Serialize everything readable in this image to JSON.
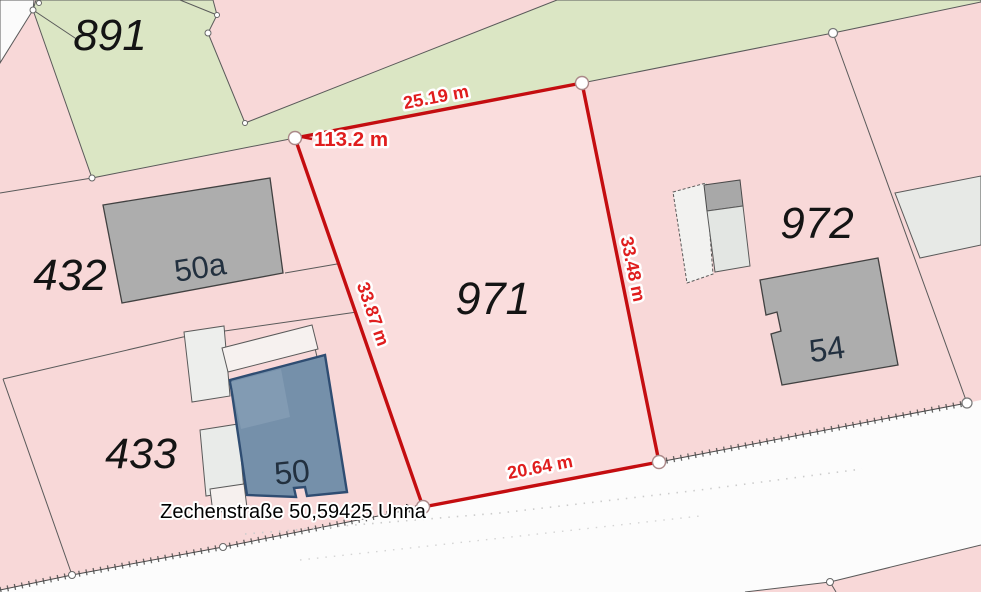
{
  "map": {
    "type": "cadastral-parcel-map",
    "labels": {
      "parcel_891": "891",
      "parcel_432": "432",
      "parcel_433": "433",
      "parcel_971": "971",
      "parcel_972": "972",
      "building_50a": "50a",
      "building_50": "50",
      "building_54": "54"
    },
    "measurements": {
      "top_edge": "25.19 m",
      "left_edge": "33.87 m",
      "right_edge": "33.48 m",
      "bottom_edge": "20.64 m",
      "total_label": "113.2 m"
    },
    "address": "Zechenstraße 50,59425 Unna",
    "colors": {
      "parcel_pink": "#f8d8d8",
      "parcel_green": "#dbe6c4",
      "road_white": "#fcfcfc",
      "highlight_red": "#c40d10",
      "measure_red": "#e01e1e",
      "building_gray": "#adadad",
      "building_blue": "#7590aa",
      "building_blue_border": "#2f4d72",
      "outbuilding_light": "#e9ebe9"
    }
  }
}
